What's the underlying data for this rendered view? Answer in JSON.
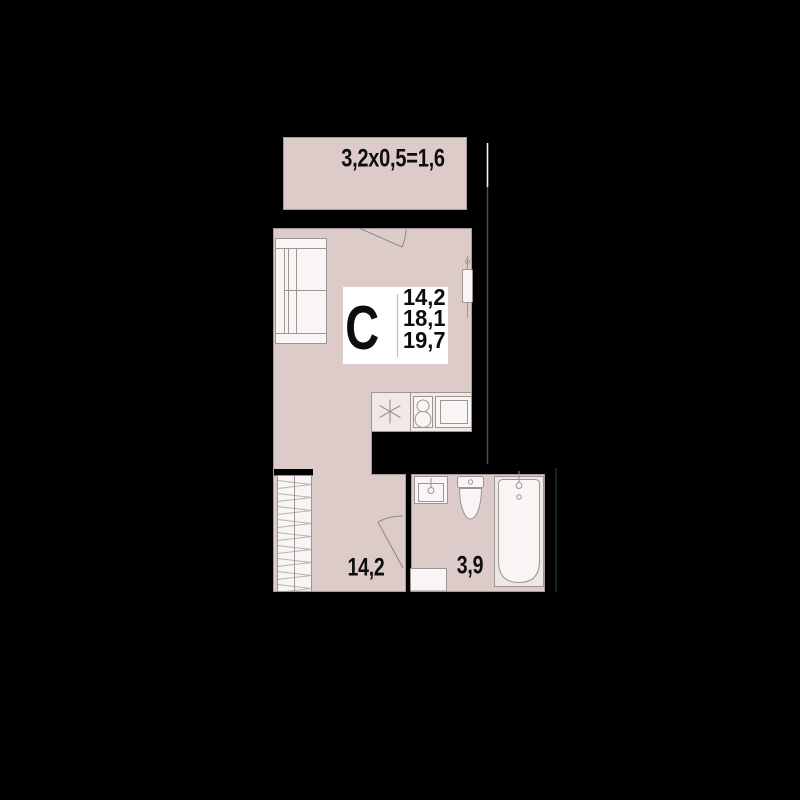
{
  "theme": {
    "background": "#000000",
    "wall_color": "#000000",
    "room_fill": "#dccbc9",
    "room_stroke": "#a59b99",
    "furniture_fill": "#f8f5f4",
    "furniture_stroke": "#9d9593",
    "counter_fill": "#f2e8e6",
    "tub_rim_fill": "#f0e7e5",
    "badge_fill": "#ffffff",
    "divider_color": "#c2bab8",
    "hatch_color": "#b7b0ae",
    "door_color": "#8f8784",
    "text_color": "#0d0d0d",
    "facade_white": "#f2f2f2",
    "facade_dark": "#41525c",
    "facade_faint": "#23313a"
  },
  "floorplan": {
    "balcony": {
      "dimension_label": "3,2x0,5=1,6"
    },
    "unit_badge": {
      "type_letter": "С",
      "areas": [
        "14,2",
        "18,1",
        "19,7"
      ]
    },
    "hallway": {
      "area_label": "14,2"
    },
    "bathroom": {
      "area_label": "3,9"
    },
    "icons": {
      "sofa": "sofa-icon",
      "radiator": "radiator-icon",
      "kitchen_sink": "sink-asterisk-icon",
      "stove": "stove-icon",
      "fridge": "fridge-icon",
      "wardrobe": "wardrobe-icon",
      "washing_machine": "washing-machine-icon",
      "washbasin": "washbasin-icon",
      "toilet": "toilet-icon",
      "bathtub": "bathtub-icon",
      "door_swing": "door-swing-icon"
    }
  }
}
